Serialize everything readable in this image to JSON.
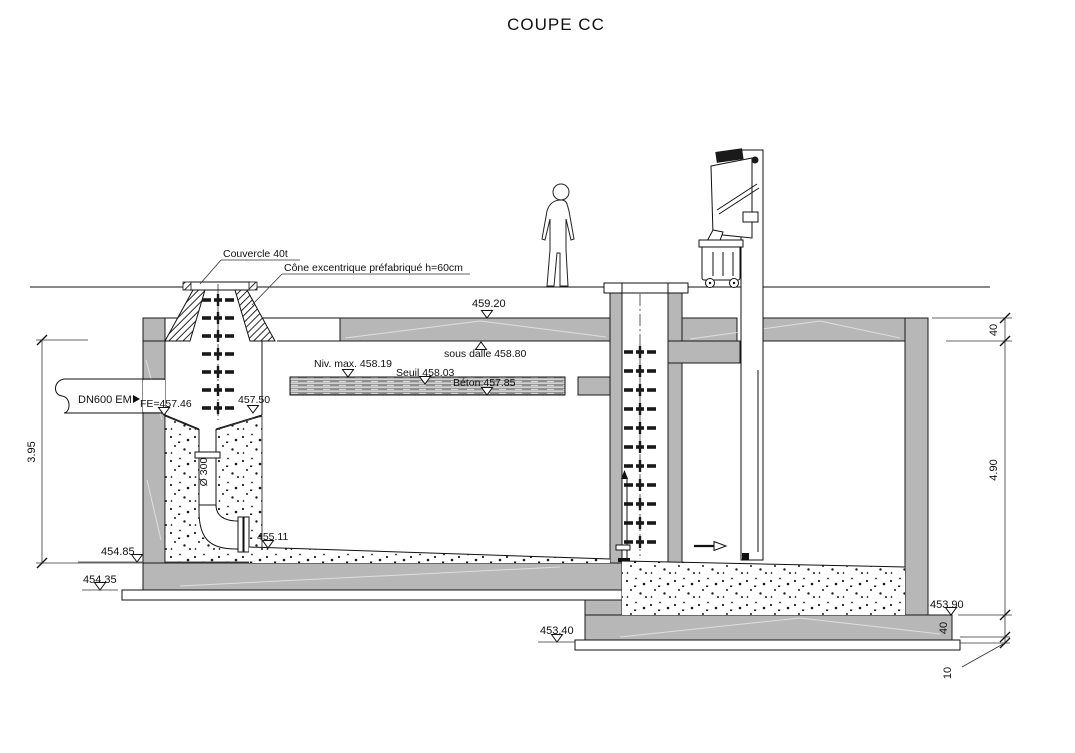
{
  "title": "COUPE CC",
  "colors": {
    "line": "#1a1a1a",
    "concrete_gray": "#b7b7b7",
    "background": "#ffffff"
  },
  "callouts": {
    "cover": "Couvercle 40t",
    "cone": "Cône excentrique préfabriqué h=60cm"
  },
  "pipes": {
    "inlet": "DN600 EM",
    "drop_pipe": "Ø 300"
  },
  "levels": {
    "top_slab": "459.20",
    "under_slab": "sous dalle 458.80",
    "max_water": "Niv. max. 458.19",
    "sill": "Seuil 458.03",
    "concrete_top": "Béton 457.85",
    "inlet_invert": "FE=457.46",
    "chute_top": "457.50",
    "outlet_invert": "455.11",
    "floor": "454.85",
    "under_base_left": "454.35",
    "footing_right": "453.90",
    "under_base_right": "453.40"
  },
  "dimensions": {
    "interior_height_left": "3.95",
    "interior_height_right": "4.90",
    "slab_thickness": "40",
    "base_thickness": "40",
    "blinding_thickness": "10"
  }
}
